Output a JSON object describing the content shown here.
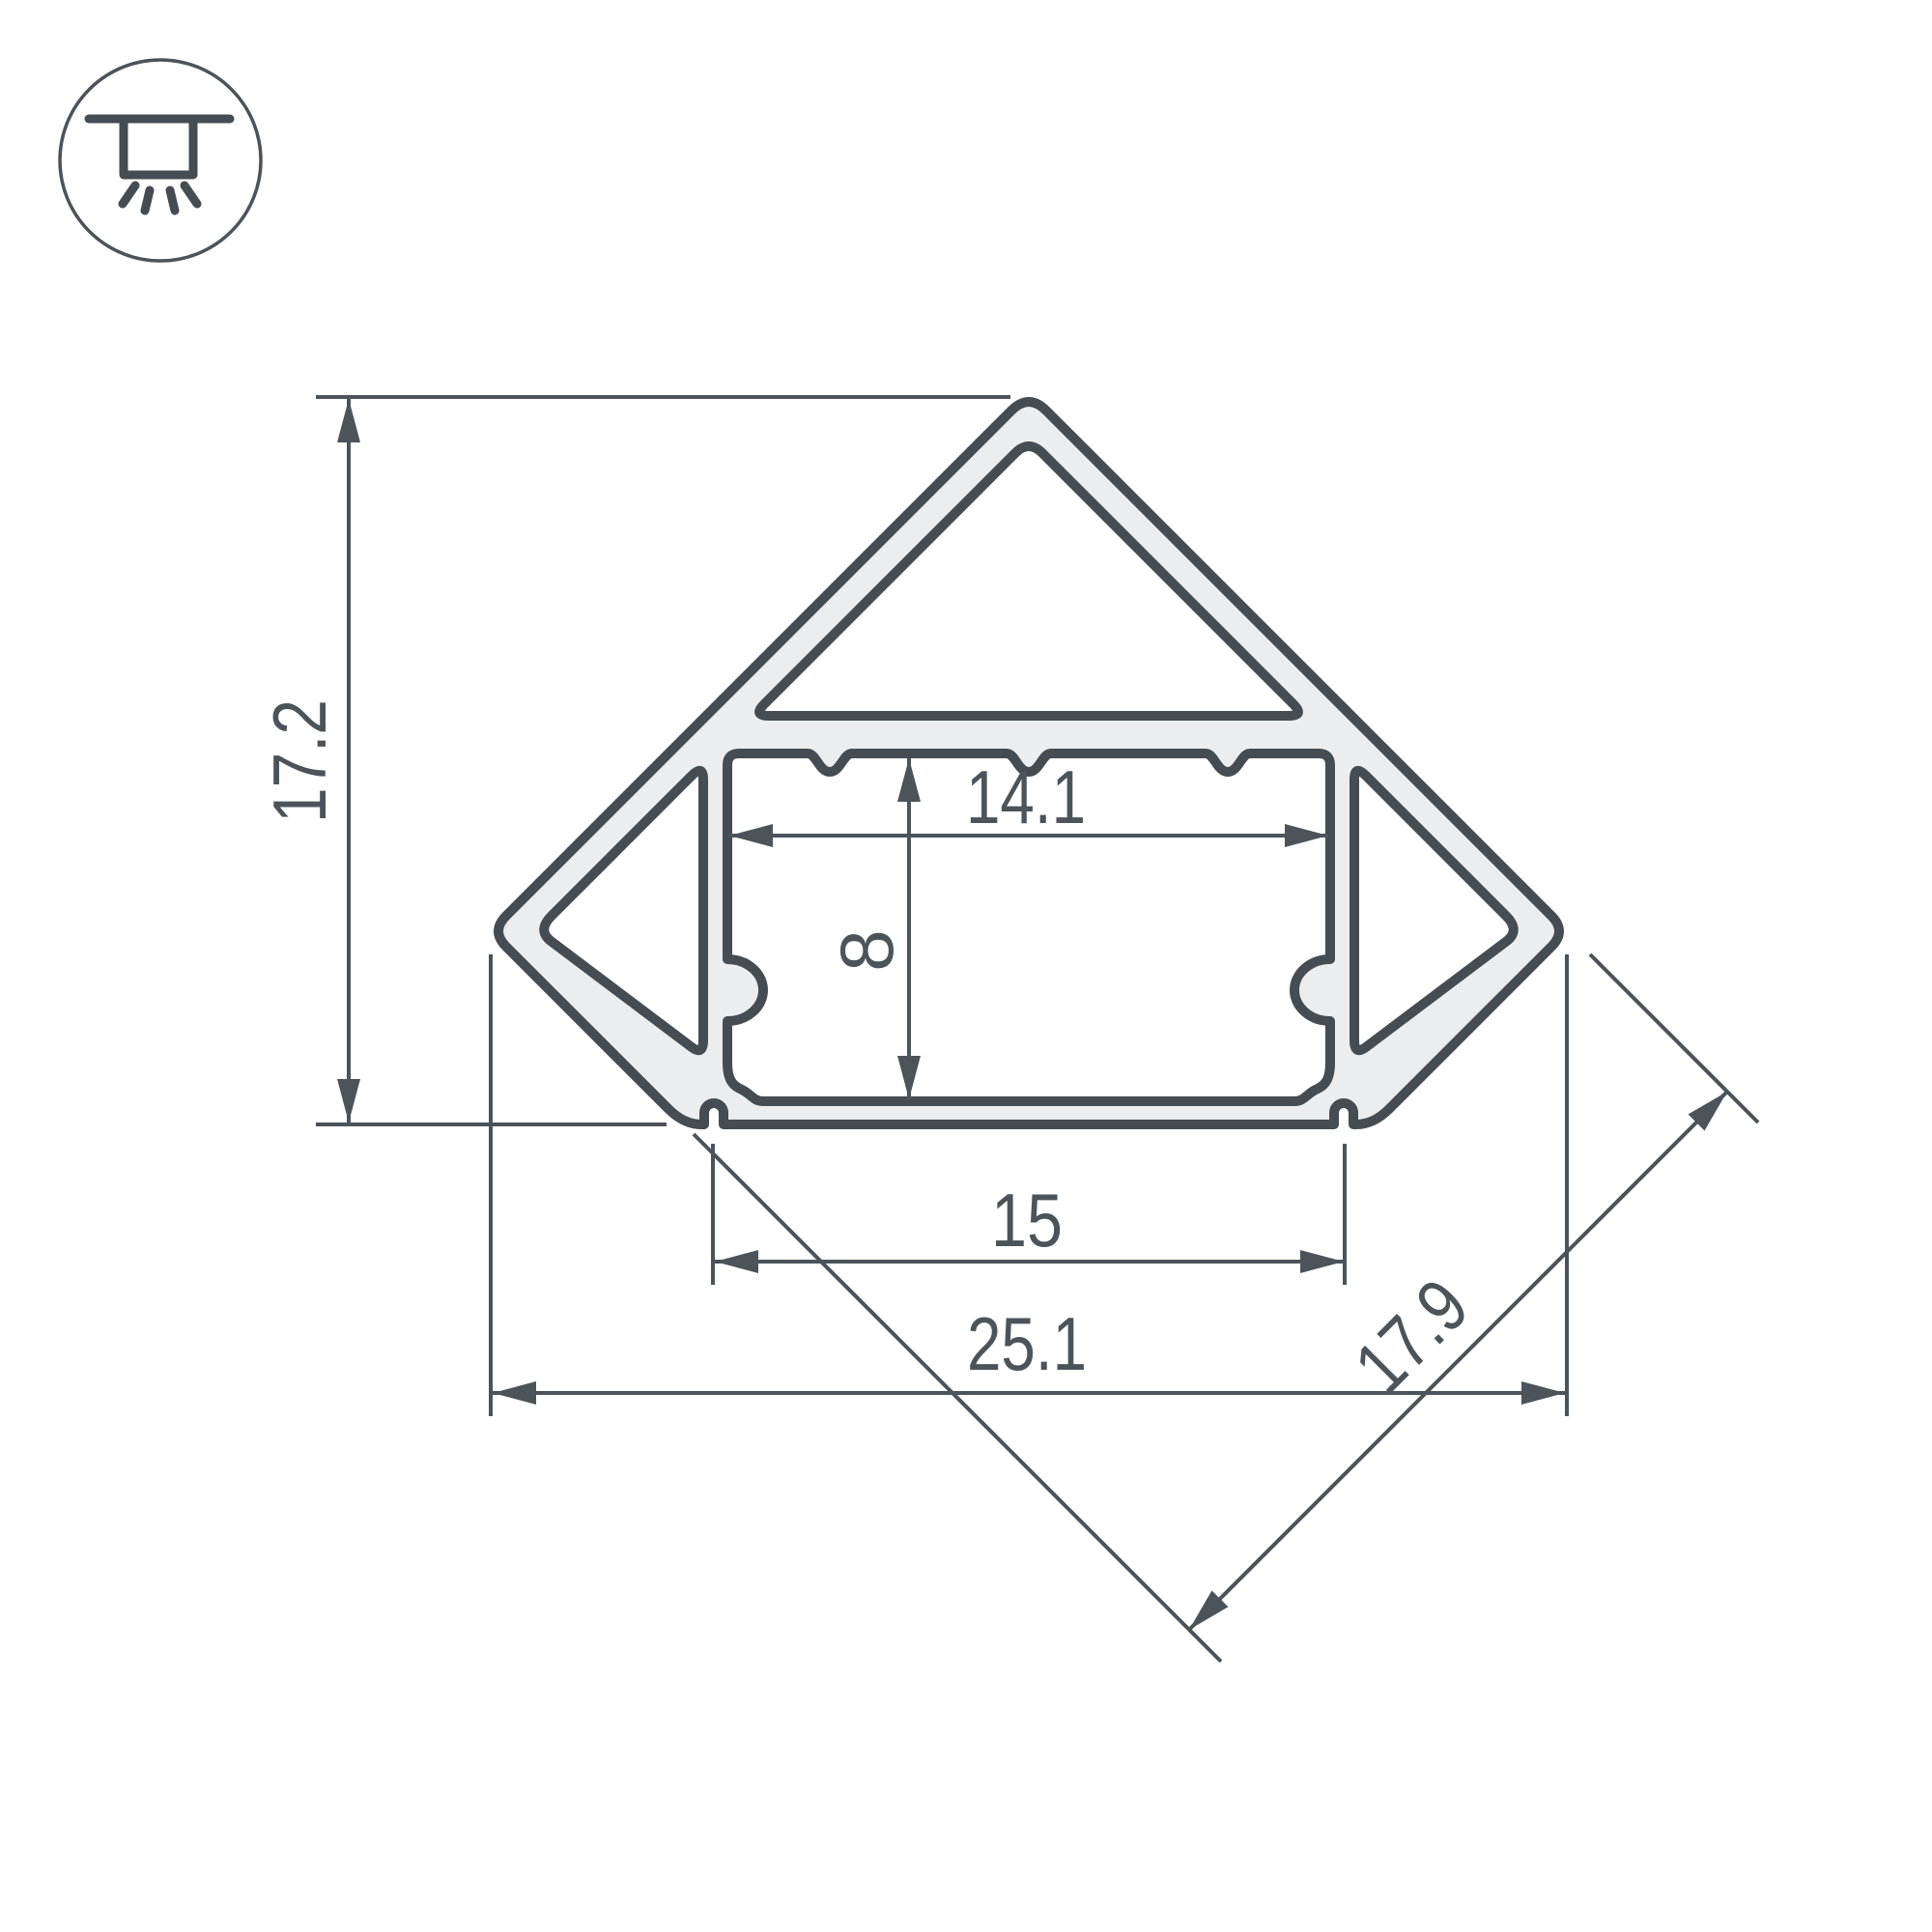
{
  "icon": {
    "name": "recessed-light-icon"
  },
  "dimensions": {
    "overall_height": "17.2",
    "channel_width": "14.1",
    "channel_height": "8",
    "base_width": "15",
    "overall_width": "25.1",
    "face_width": "17.9"
  },
  "colors": {
    "line": "#4c545a",
    "outline": "#454c52",
    "material_fill": "#ecedee",
    "background": "#ffffff"
  }
}
